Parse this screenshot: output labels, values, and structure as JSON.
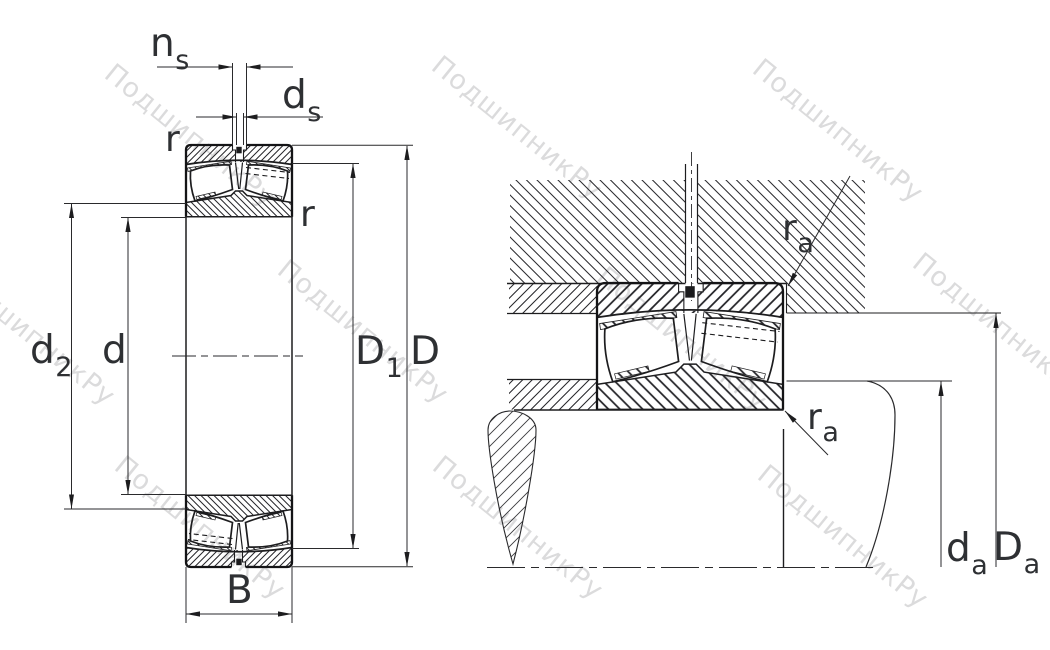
{
  "drawing": {
    "type": "bearing-technical-drawing",
    "views": [
      "bearing cross-section with dimensions",
      "mounting arrangement with abutment dimensions"
    ]
  },
  "watermark": {
    "text": "ПодшипникРу"
  },
  "labels": {
    "ns": {
      "main": "n",
      "sub": "s"
    },
    "ds": {
      "main": "d",
      "sub": "s"
    },
    "r_outer": "r",
    "r_inner": "r",
    "d2": {
      "main": "d",
      "sub": "2"
    },
    "d": "d",
    "D1": {
      "main": "D",
      "sub": "1"
    },
    "D": "D",
    "B": "B",
    "ra_housing": {
      "main": "r",
      "sub": "a"
    },
    "ra_shaft": {
      "main": "r",
      "sub": "a"
    },
    "da": {
      "main": "d",
      "sub": "a"
    },
    "Da": {
      "main": "D",
      "sub": "a"
    }
  },
  "colors": {
    "background": "#ffffff",
    "line": "#1d1d1f",
    "label": "#2e3033",
    "watermark": "rgba(40,40,45,0.17)"
  }
}
